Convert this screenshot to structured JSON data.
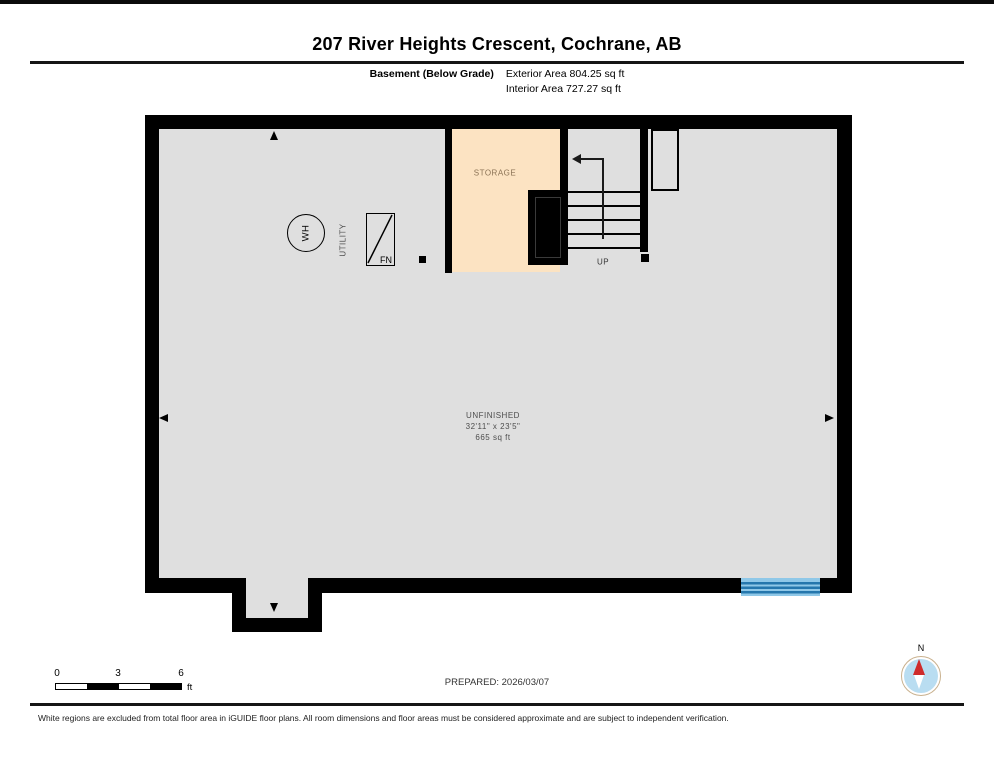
{
  "title": "207 River Heights Crescent, Cochrane, AB",
  "header": {
    "floor_label": "Basement (Below Grade)",
    "exterior_area": "Exterior Area 804.25 sq ft",
    "interior_area": "Interior Area 727.27 sq ft"
  },
  "plan": {
    "storage": {
      "label": "STORAGE"
    },
    "utility": {
      "label": "UTILITY"
    },
    "unfinished": {
      "label": "UNFINISHED",
      "dimensions": "32'11\" x 23'5\"",
      "area": "665 sq ft"
    },
    "stairs": {
      "direction_label": "UP"
    },
    "fixtures": {
      "water_heater_label": "WH",
      "furnace_label": "FN"
    }
  },
  "footer": {
    "scale": {
      "ticks": [
        "0",
        "3",
        "6"
      ],
      "unit": "ft"
    },
    "prepared": "PREPARED: 2026/03/07",
    "compass_label": "N",
    "disclaimer": "White regions are excluded from total floor area in iGUIDE floor plans. All room dimensions and floor areas must be considered approximate and are subject to independent verification."
  },
  "colors": {
    "wall": "#000000",
    "floor": "#dfdfdf",
    "storage_fill": "#fce3c2",
    "window_light": "#8fc8e8",
    "window_dark": "#2577ad",
    "compass_red": "#cf2b2b",
    "compass_blue": "#b9ddf1"
  }
}
